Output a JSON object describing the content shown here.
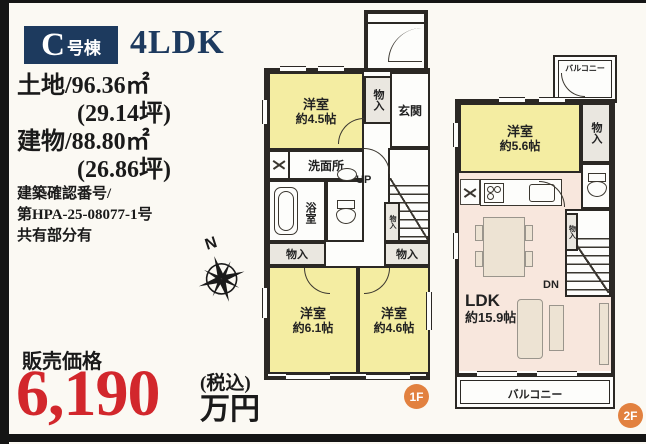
{
  "header": {
    "unit_letter": "C",
    "unit_suffix": "号棟",
    "layout_type": "4LDK"
  },
  "details": {
    "land": "土地/96.36㎡",
    "land_tsubo": "(29.14坪)",
    "building": "建物/88.80㎡",
    "building_tsubo": "(26.86坪)",
    "permit_label": "建築確認番号/",
    "permit_number": "第HPA-25-08077-1号",
    "shared_note": "共有部分有"
  },
  "price": {
    "label": "販売価格",
    "amount": "6,190",
    "tax_note": "(税込)",
    "unit": "万円"
  },
  "compass": {
    "north_label": "N"
  },
  "floors": {
    "f1": {
      "badge": "1F",
      "rooms": {
        "western1": {
          "name": "洋室",
          "size": "約4.5帖"
        },
        "entrance": "玄関",
        "closet_entry": "物入",
        "washroom": "洗面所",
        "bath": "浴室",
        "stairs_up": "UP",
        "closet_stair": "物入",
        "closet_west": "物入",
        "closet_east": "物入",
        "western2": {
          "name": "洋室",
          "size": "約6.1帖"
        },
        "western3": {
          "name": "洋室",
          "size": "約4.6帖"
        }
      }
    },
    "f2": {
      "badge": "2F",
      "rooms": {
        "balcony_top": "バルコニー",
        "western": {
          "name": "洋室",
          "size": "約5.6帖"
        },
        "closet": "物入",
        "closet_stair": "物入",
        "ldk": {
          "name": "LDK",
          "size": "約15.9帖"
        },
        "stairs_down": "DN",
        "balcony_bottom": "バルコニー"
      }
    }
  },
  "colors": {
    "accent_navy": "#1d3a5e",
    "price_red": "#d2272c",
    "room_yellow": "#f4eda2",
    "ldk_pink": "#f8e7dd",
    "badge_orange": "#e2813f",
    "wall": "#2b2824"
  }
}
